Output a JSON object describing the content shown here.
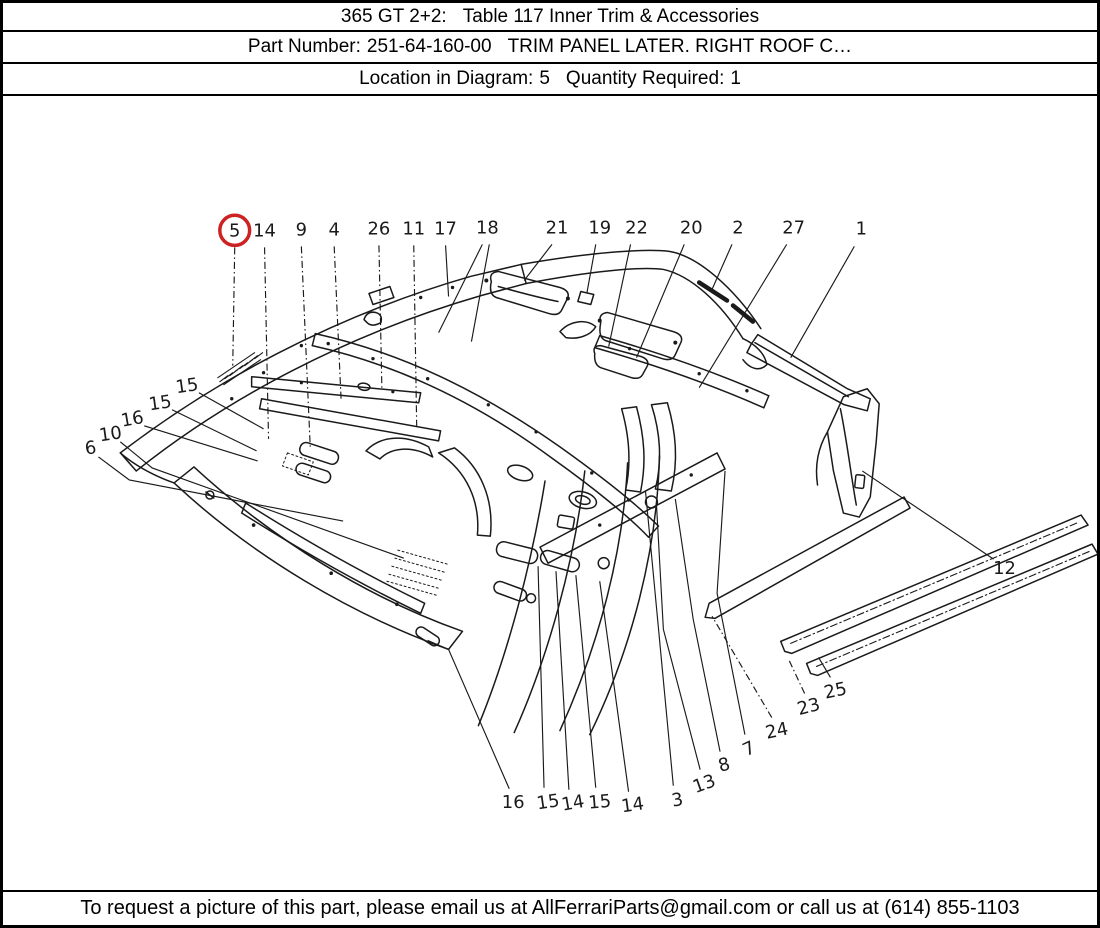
{
  "header": {
    "row1": {
      "model": "365 GT 2+2:",
      "table_title": "Table 117 Inner Trim & Accessories"
    },
    "row2": {
      "part_label": "Part Number:",
      "part_number": "251-64-160-00",
      "part_description": "TRIM PANEL LATER. RIGHT ROOF C…"
    },
    "row3": {
      "location_label": "Location in Diagram:",
      "location_value": "5",
      "quantity_label": "Quantity Required:",
      "quantity_value": "1"
    }
  },
  "footer": {
    "text": "To request a picture of this part, please email us at AllFerrariParts@gmail.com or call us at (614) 855-1103"
  },
  "diagram": {
    "highlighted_callout": "5",
    "colors": {
      "ink": "#1a1a1a",
      "highlight": "#cc2222",
      "background": "#ffffff"
    },
    "callouts": [
      {
        "label": "5",
        "x": 233,
        "y": 230,
        "rot": 0,
        "circled": true,
        "dash": true,
        "leaders": [
          [
            [
              233,
              247
            ],
            [
              231,
              365
            ]
          ]
        ]
      },
      {
        "label": "14",
        "x": 263,
        "y": 230,
        "rot": 0,
        "circled": false,
        "dash": true,
        "leaders": [
          [
            [
              263,
              247
            ],
            [
              267,
              438
            ]
          ]
        ]
      },
      {
        "label": "9",
        "x": 300,
        "y": 229,
        "rot": 0,
        "circled": false,
        "dash": true,
        "leaders": [
          [
            [
              300,
              246
            ],
            [
              309,
              448
            ]
          ]
        ]
      },
      {
        "label": "4",
        "x": 333,
        "y": 229,
        "rot": 0,
        "circled": false,
        "dash": true,
        "leaders": [
          [
            [
              333,
              246
            ],
            [
              340,
              400
            ]
          ]
        ]
      },
      {
        "label": "26",
        "x": 378,
        "y": 228,
        "rot": 0,
        "circled": false,
        "dash": true,
        "leaders": [
          [
            [
              378,
              245
            ],
            [
              381,
              390
            ]
          ]
        ]
      },
      {
        "label": "11",
        "x": 413,
        "y": 228,
        "rot": 0,
        "circled": false,
        "dash": true,
        "leaders": [
          [
            [
              413,
              245
            ],
            [
              416,
              428
            ]
          ]
        ]
      },
      {
        "label": "17",
        "x": 445,
        "y": 228,
        "rot": 0,
        "circled": false,
        "dash": false,
        "leaders": [
          [
            [
              445,
              245
            ],
            [
              448,
              296
            ]
          ]
        ]
      },
      {
        "label": "18",
        "x": 487,
        "y": 227,
        "rot": 0,
        "circled": false,
        "dash": false,
        "leaders": [
          [
            [
              482,
              244
            ],
            [
              438,
              332
            ]
          ],
          [
            [
              489,
              244
            ],
            [
              471,
              341
            ]
          ]
        ]
      },
      {
        "label": "21",
        "x": 557,
        "y": 227,
        "rot": 0,
        "circled": false,
        "dash": false,
        "leaders": [
          [
            [
              552,
              244
            ],
            [
              524,
              280
            ]
          ]
        ]
      },
      {
        "label": "19",
        "x": 600,
        "y": 227,
        "rot": 0,
        "circled": false,
        "dash": false,
        "leaders": [
          [
            [
              596,
              244
            ],
            [
              587,
              293
            ]
          ]
        ]
      },
      {
        "label": "22",
        "x": 637,
        "y": 227,
        "rot": 0,
        "circled": false,
        "dash": false,
        "leaders": [
          [
            [
              631,
              244
            ],
            [
              609,
              346
            ]
          ]
        ]
      },
      {
        "label": "20",
        "x": 692,
        "y": 227,
        "rot": 0,
        "circled": false,
        "dash": false,
        "leaders": [
          [
            [
              685,
              244
            ],
            [
              637,
              357
            ]
          ]
        ]
      },
      {
        "label": "2",
        "x": 739,
        "y": 227,
        "rot": 0,
        "circled": false,
        "dash": false,
        "leaders": [
          [
            [
              733,
              244
            ],
            [
              712,
              291
            ]
          ]
        ]
      },
      {
        "label": "27",
        "x": 795,
        "y": 227,
        "rot": 0,
        "circled": false,
        "dash": false,
        "leaders": [
          [
            [
              788,
              244
            ],
            [
              700,
              387
            ]
          ]
        ]
      },
      {
        "label": "1",
        "x": 863,
        "y": 228,
        "rot": 0,
        "circled": false,
        "dash": false,
        "leaders": [
          [
            [
              856,
              246
            ],
            [
              792,
              357
            ]
          ]
        ]
      },
      {
        "label": "15",
        "x": 185,
        "y": 385,
        "rot": -8,
        "circled": false,
        "dash": false,
        "leaders": [
          [
            [
              197,
              392
            ],
            [
              262,
              428
            ]
          ]
        ]
      },
      {
        "label": "15",
        "x": 158,
        "y": 402,
        "rot": -8,
        "circled": false,
        "dash": false,
        "leaders": [
          [
            [
              170,
              409
            ],
            [
              255,
              450
            ]
          ]
        ]
      },
      {
        "label": "16",
        "x": 130,
        "y": 418,
        "rot": -10,
        "circled": false,
        "dash": false,
        "leaders": [
          [
            [
              142,
              425
            ],
            [
              256,
              460
            ]
          ]
        ]
      },
      {
        "label": "10",
        "x": 108,
        "y": 433,
        "rot": -8,
        "circled": false,
        "dash": false,
        "leaders": [
          [
            [
              118,
              441
            ],
            [
              150,
              467
            ],
            [
              403,
              557
            ]
          ]
        ]
      },
      {
        "label": "6",
        "x": 88,
        "y": 447,
        "rot": -8,
        "circled": false,
        "dash": false,
        "leaders": [
          [
            [
              96,
              456
            ],
            [
              127,
              479
            ],
            [
              342,
              520
            ]
          ]
        ]
      },
      {
        "label": "16",
        "x": 513,
        "y": 800,
        "rot": 0,
        "circled": false,
        "dash": false,
        "leaders": [
          [
            [
              509,
              787
            ],
            [
              448,
              648
            ],
            [
              427,
              639
            ]
          ]
        ]
      },
      {
        "label": "15",
        "x": 548,
        "y": 800,
        "rot": -8,
        "circled": false,
        "dash": false,
        "leaders": [
          [
            [
              544,
              786
            ],
            [
              538,
              565
            ]
          ]
        ]
      },
      {
        "label": "14",
        "x": 573,
        "y": 801,
        "rot": -10,
        "circled": false,
        "dash": false,
        "leaders": [
          [
            [
              569,
              788
            ],
            [
              556,
              570
            ]
          ]
        ]
      },
      {
        "label": "15",
        "x": 600,
        "y": 800,
        "rot": -5,
        "circled": false,
        "dash": false,
        "leaders": [
          [
            [
              596,
              786
            ],
            [
              576,
              574
            ]
          ]
        ]
      },
      {
        "label": "14",
        "x": 633,
        "y": 803,
        "rot": -8,
        "circled": false,
        "dash": false,
        "leaders": [
          [
            [
              629,
              790
            ],
            [
              600,
              580
            ]
          ]
        ]
      },
      {
        "label": "3",
        "x": 678,
        "y": 798,
        "rot": -10,
        "circled": false,
        "dash": false,
        "leaders": [
          [
            [
              674,
              784
            ],
            [
              646,
              490
            ]
          ]
        ]
      },
      {
        "label": "13",
        "x": 705,
        "y": 782,
        "rot": -20,
        "circled": false,
        "dash": false,
        "leaders": [
          [
            [
              701,
              768
            ],
            [
              664,
              628
            ],
            [
              657,
              502
            ]
          ]
        ]
      },
      {
        "label": "8",
        "x": 725,
        "y": 763,
        "rot": -15,
        "circled": false,
        "dash": false,
        "leaders": [
          [
            [
              721,
              750
            ],
            [
              694,
              618
            ],
            [
              676,
              498
            ]
          ]
        ]
      },
      {
        "label": "7",
        "x": 750,
        "y": 747,
        "rot": -25,
        "circled": false,
        "dash": false,
        "leaders": [
          [
            [
              746,
              733
            ],
            [
              718,
              592
            ],
            [
              726,
              470
            ]
          ]
        ]
      },
      {
        "label": "24",
        "x": 778,
        "y": 729,
        "rot": -12,
        "circled": false,
        "dash": true,
        "leaders": [
          [
            [
              773,
              716
            ],
            [
              713,
              615
            ]
          ]
        ]
      },
      {
        "label": "23",
        "x": 810,
        "y": 705,
        "rot": -15,
        "circled": false,
        "dash": true,
        "leaders": [
          [
            [
              806,
              692
            ],
            [
              790,
              658
            ]
          ]
        ]
      },
      {
        "label": "25",
        "x": 837,
        "y": 689,
        "rot": -12,
        "circled": false,
        "dash": false,
        "leaders": [
          [
            [
              832,
              676
            ],
            [
              820,
              656
            ]
          ]
        ]
      },
      {
        "label": "12",
        "x": 1007,
        "y": 567,
        "rot": 0,
        "circled": false,
        "dash": false,
        "leaders": [
          [
            [
              996,
              558
            ],
            [
              864,
              470
            ]
          ]
        ]
      }
    ]
  }
}
